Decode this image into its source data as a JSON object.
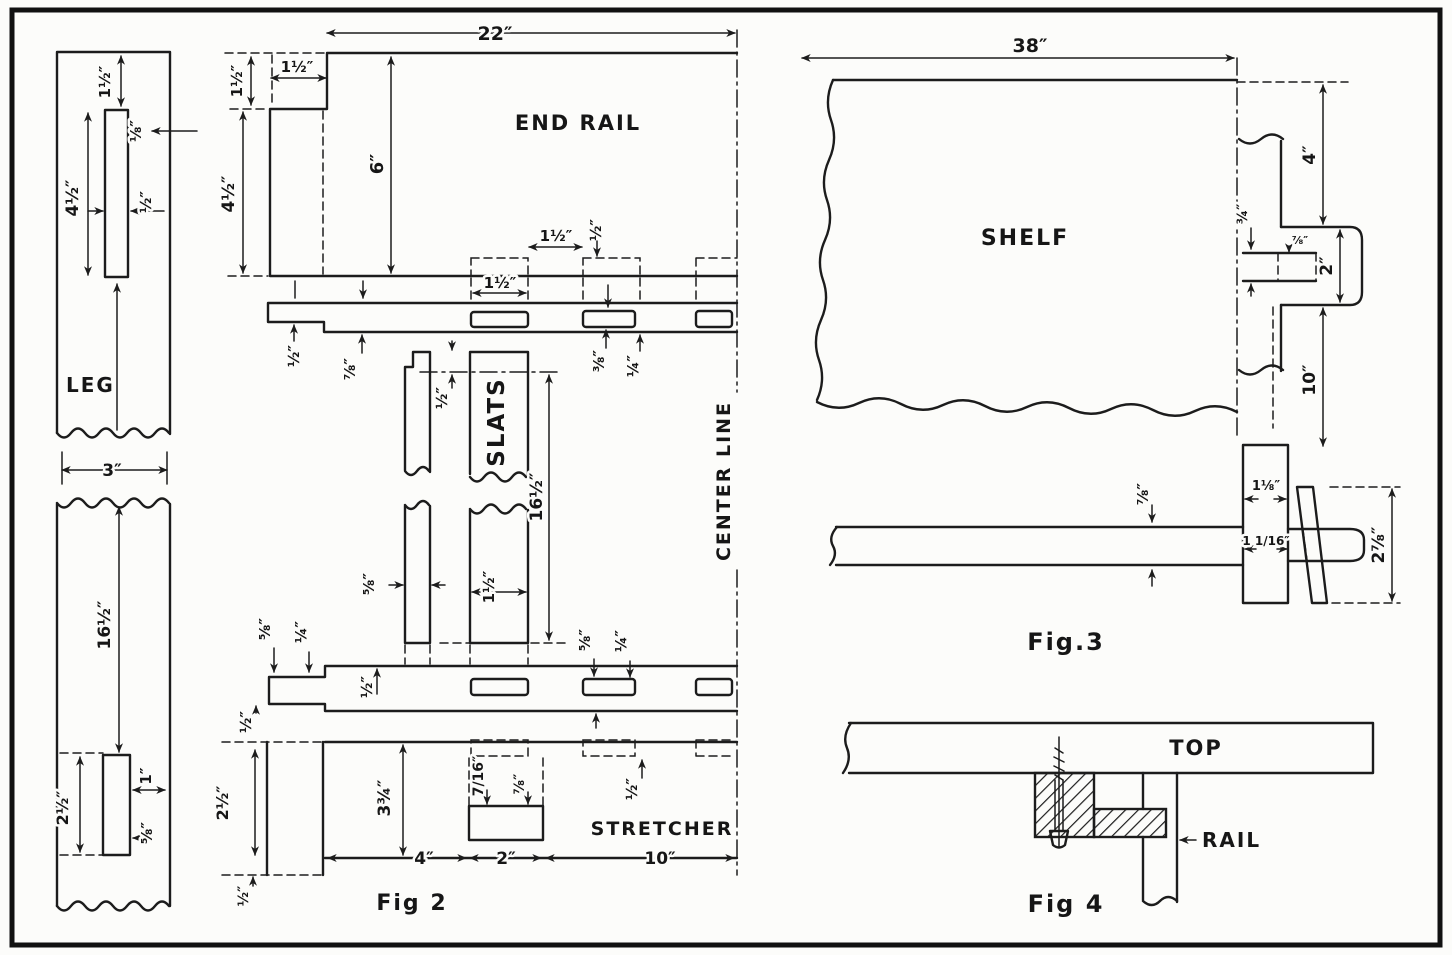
{
  "page": {
    "background": "#fcfcfa",
    "ink_color": "#1c1c1c"
  },
  "fig2": {
    "caption": "Fig 2",
    "center_line_label": "CENTER LINE",
    "leg": {
      "name": "LEG",
      "width": "3″",
      "length": "16½″",
      "mortise_top_offset": "1½″",
      "mortise_side_offset": "⅛″",
      "mortise_length_upper": "4½″",
      "mortise_width_upper": "½″",
      "mortise_length_lower": "2½″",
      "edge_distance": "1″",
      "mortise_width_lower": "⅝″"
    },
    "end_rail": {
      "name": "END RAIL",
      "length": "22″",
      "height": "6″",
      "tenon_height": "1½″",
      "tenon_width": "1½″",
      "shoulder_height": "4½″",
      "slot_width": "1½″",
      "slot_gap": "1½″",
      "slot_offset": "½″",
      "edge_half": "½″",
      "thickness": "⅞″",
      "slot_depth": "⅜″",
      "slot_inset": "¼″"
    },
    "slats": {
      "name": "SLATS",
      "length": "16½″",
      "top_offset": "½″",
      "narrow_width": "⅝″",
      "wide_width": "1½″"
    },
    "lower_rail": {
      "tenon_depth": "⅝″",
      "tenon_inset": "¼″",
      "inner_half": "½″",
      "left_half": "½″",
      "slot_depth": "⅝″",
      "slot_inset": "¼″",
      "below_half": "½″"
    },
    "stretcher": {
      "name": "STRETCHER",
      "leg_mortise": "2½″",
      "height": "3¾″",
      "tenon_a": "7/16″",
      "tenon_b": "⅞″",
      "dim_4": "4″",
      "dim_2": "2″",
      "dim_10": "10″",
      "bottom_offset": "½″"
    }
  },
  "fig3": {
    "caption": "Fig.3",
    "shelf": {
      "name": "SHELF",
      "width": "38″",
      "top_gap": "4″",
      "notch_depth": "¾″",
      "leg_thickness": "⅞″",
      "tab_height": "2″",
      "bottom_gap": "10″"
    },
    "detail": {
      "rail_thickness": "⅞″",
      "leg_dim_a": "1⅛″",
      "leg_dim_b": "1 1/16″",
      "tenon_depth": "2⅞″"
    }
  },
  "fig4": {
    "caption": "Fig 4",
    "top_label": "TOP",
    "rail_label": "RAIL"
  }
}
